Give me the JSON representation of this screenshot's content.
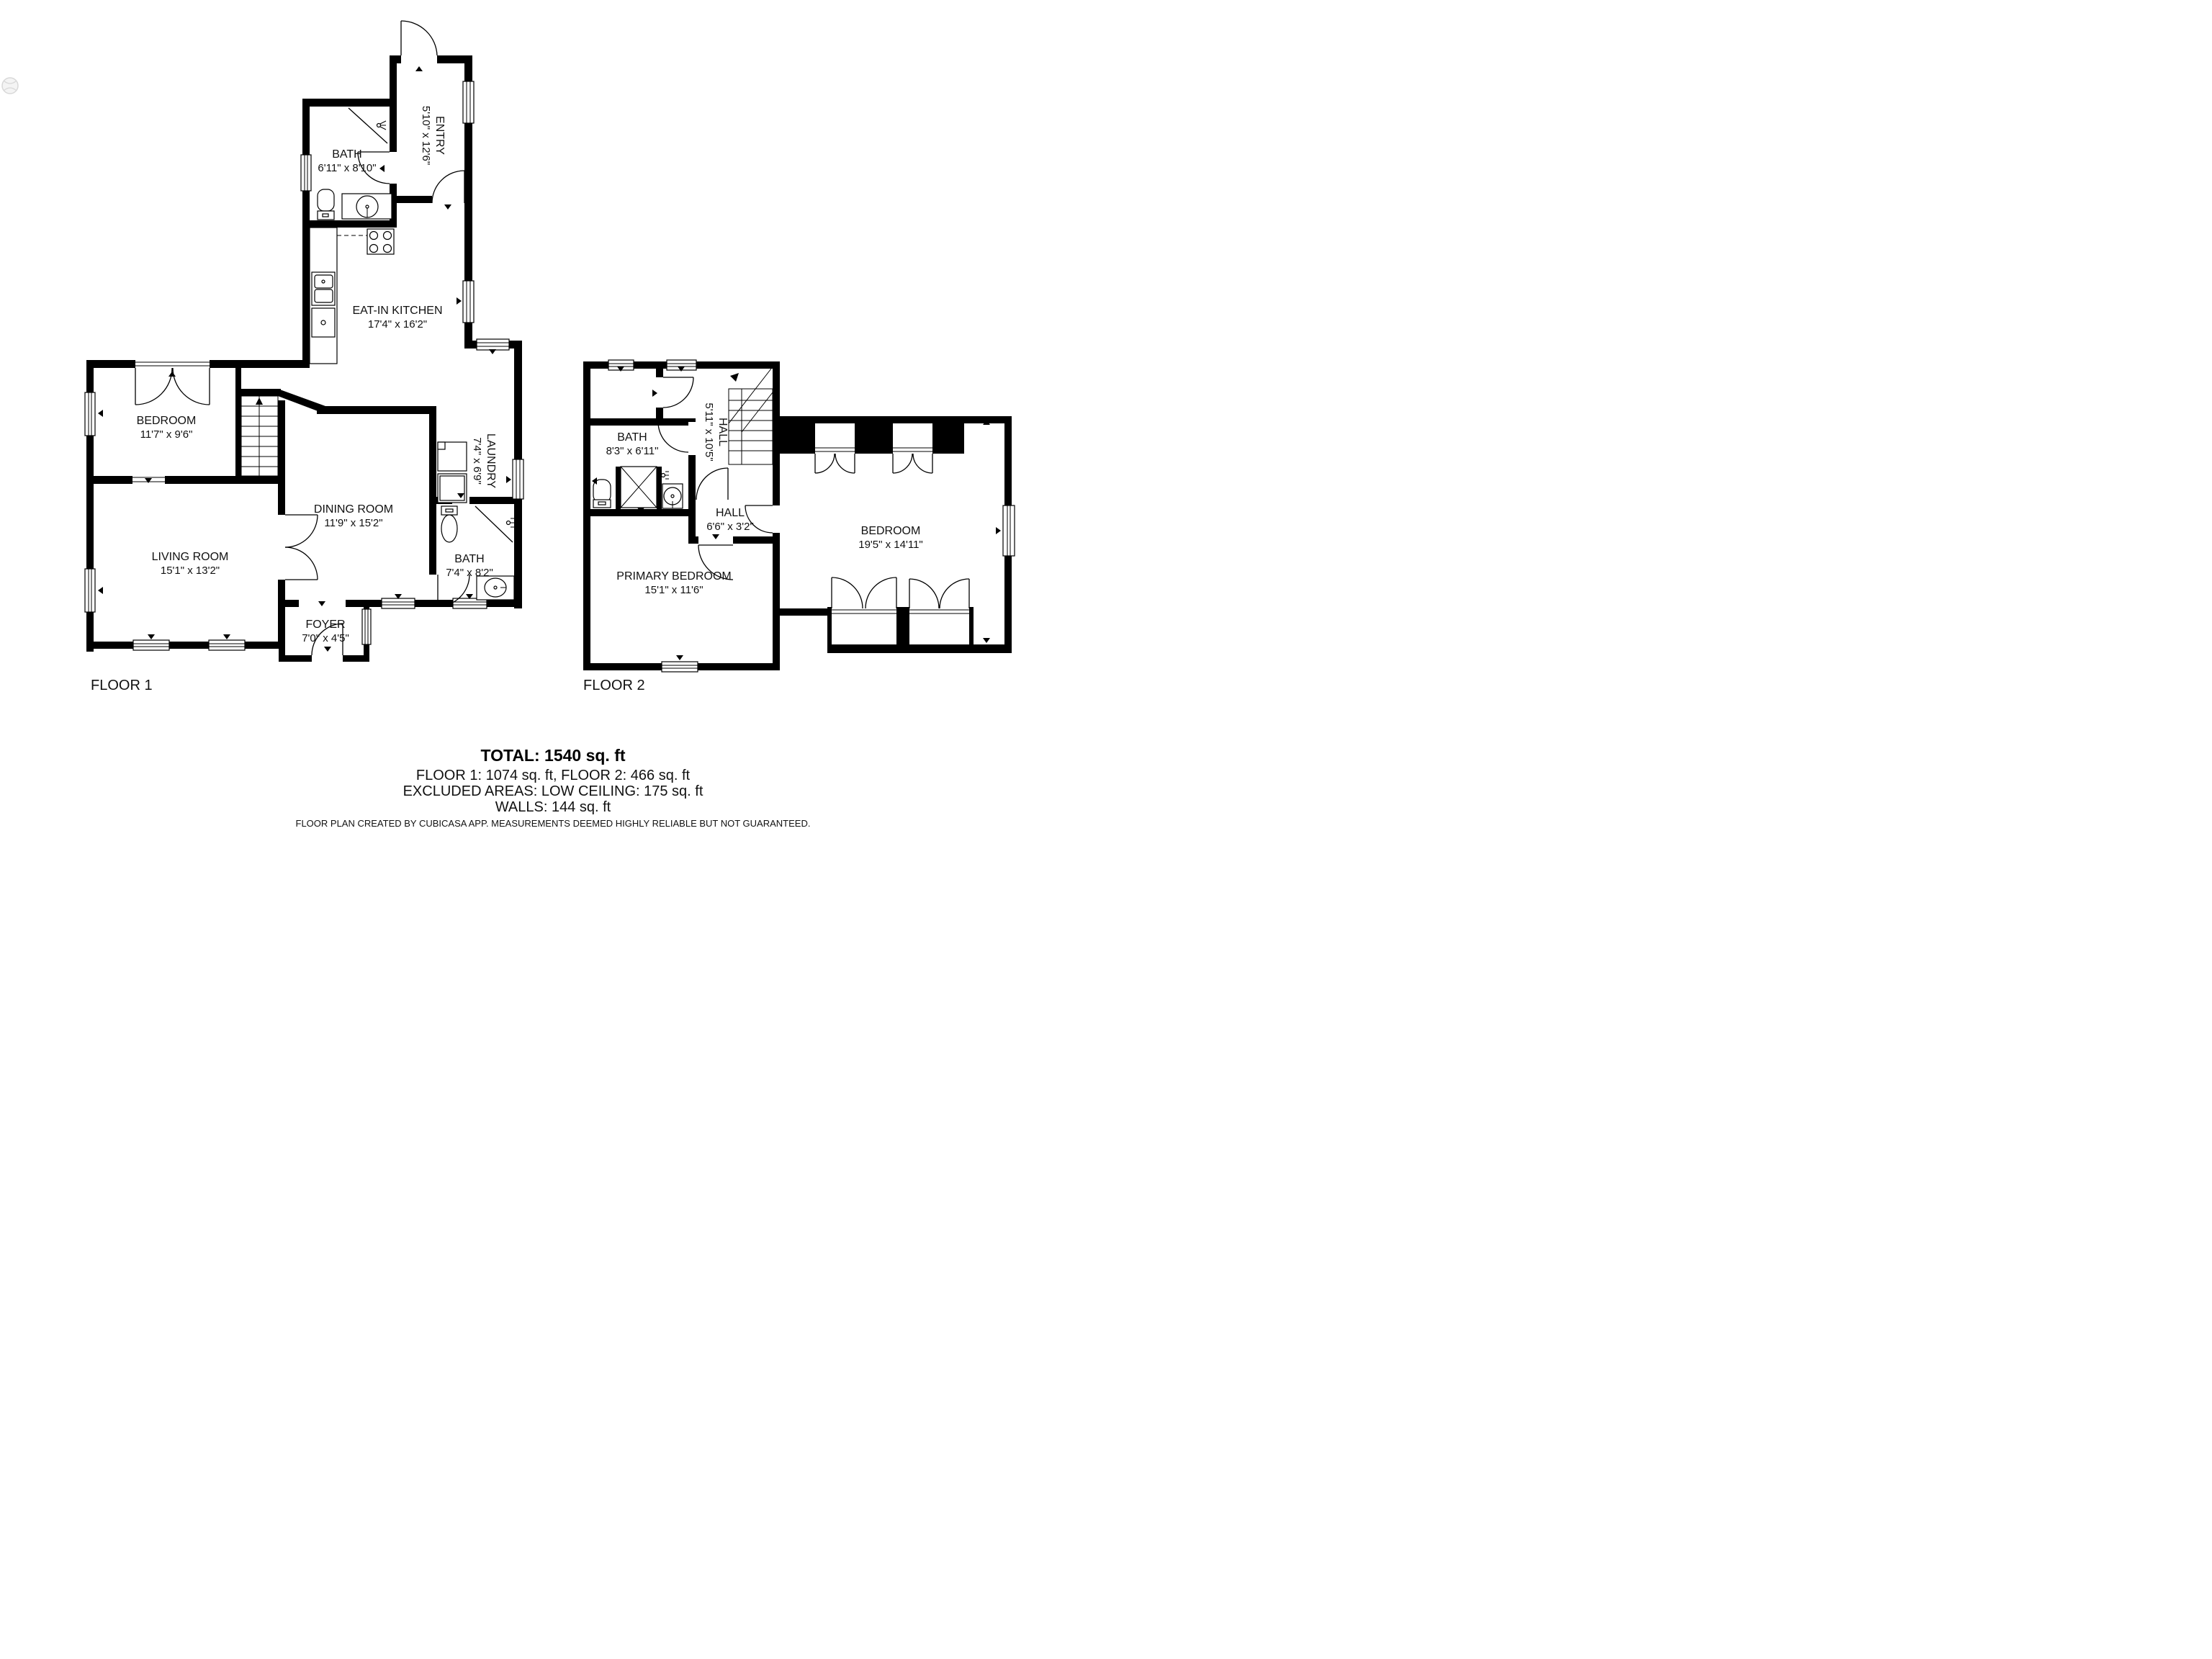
{
  "floor1": {
    "label": "FLOOR 1",
    "rooms": {
      "entry": {
        "name": "ENTRY",
        "dims": "5'10\" x 12'6\""
      },
      "bath_upper": {
        "name": "BATH",
        "dims": "6'11\" x 8'10\""
      },
      "kitchen": {
        "name": "EAT-IN KITCHEN",
        "dims": "17'4\" x 16'2\""
      },
      "bedroom": {
        "name": "BEDROOM",
        "dims": "11'7\" x 9'6\""
      },
      "living": {
        "name": "LIVING ROOM",
        "dims": "15'1\" x 13'2\""
      },
      "dining": {
        "name": "DINING ROOM",
        "dims": "11'9\" x 15'2\""
      },
      "laundry": {
        "name": "LAUNDRY",
        "dims": "7'4\" x 6'9\""
      },
      "bath_lower": {
        "name": "BATH",
        "dims": "7'4\" x 8'2\""
      },
      "foyer": {
        "name": "FOYER",
        "dims": "7'0\" x 4'5\""
      }
    }
  },
  "floor2": {
    "label": "FLOOR 2",
    "rooms": {
      "bath": {
        "name": "BATH",
        "dims": "8'3\" x 6'11\""
      },
      "hall_stair": {
        "name": "HALL",
        "dims": "5'11\" x 10'5\""
      },
      "hall_small": {
        "name": "HALL",
        "dims": "6'6\" x 3'2\""
      },
      "primary": {
        "name": "PRIMARY BEDROOM",
        "dims": "15'1\" x 11'6\""
      },
      "bedroom": {
        "name": "BEDROOM",
        "dims": "19'5\" x 14'11\""
      }
    }
  },
  "summary": {
    "total": "TOTAL: 1540 sq. ft",
    "floors": "FLOOR 1: 1074 sq. ft, FLOOR 2: 466 sq. ft",
    "excluded": "EXCLUDED AREAS: LOW CEILING: 175 sq. ft",
    "walls": "WALLS: 144 sq. ft"
  },
  "footer": "FLOOR PLAN CREATED BY CUBICASA APP. MEASUREMENTS DEEMED HIGHLY RELIABLE BUT NOT GUARANTEED.",
  "colors": {
    "wall": "#000000",
    "background": "#ffffff"
  }
}
